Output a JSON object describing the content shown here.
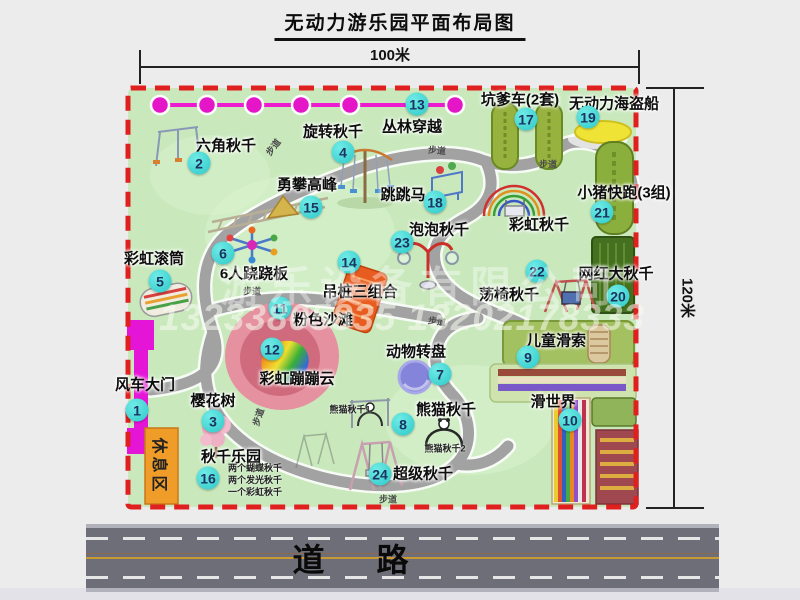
{
  "title": "无动力游乐园平面布局图",
  "dimensions": {
    "width_label": "100米",
    "height_label": "120米"
  },
  "road": {
    "label": "道路"
  },
  "watermark": {
    "company": "游乐设备有限公司",
    "phone": "13233805835 13202178333"
  },
  "rest_area": {
    "label": "休息区"
  },
  "colors": {
    "park_green": "#c9e9bd",
    "border_red": "#e01f1f",
    "badge_cyan": "#2cc9c9",
    "zipline_magenta": "#e515c8",
    "gate_magenta": "#e515d8",
    "rest_orange": "#f09c28",
    "road_gray": "#6e6e78"
  },
  "attractions": [
    {
      "num": "1",
      "name": "风车大门",
      "lx": 145,
      "ly": 384,
      "bx": 137,
      "by": 410
    },
    {
      "num": "2",
      "name": "六角秋千",
      "lx": 226,
      "ly": 145,
      "bx": 199,
      "by": 163
    },
    {
      "num": "3",
      "name": "樱花树",
      "lx": 213,
      "ly": 400,
      "bx": 213,
      "by": 421
    },
    {
      "num": "4",
      "name": "旋转秋千",
      "lx": 333,
      "ly": 131,
      "bx": 343,
      "by": 152
    },
    {
      "num": "5",
      "name": "彩虹滚筒",
      "lx": 154,
      "ly": 258,
      "bx": 160,
      "by": 281
    },
    {
      "num": "6",
      "name": "6人跷跷板",
      "lx": 254,
      "ly": 273,
      "bx": 223,
      "by": 253
    },
    {
      "num": "7",
      "name": "动物转盘",
      "lx": 416,
      "ly": 351,
      "bx": 440,
      "by": 374
    },
    {
      "num": "8",
      "name": "熊猫秋千",
      "lx": 446,
      "ly": 409,
      "bx": 403,
      "by": 424
    },
    {
      "num": "9",
      "name": "儿童滑索",
      "lx": 556,
      "ly": 340,
      "bx": 528,
      "by": 357
    },
    {
      "num": "10",
      "name": "滑世界",
      "lx": 553,
      "ly": 401,
      "bx": 570,
      "by": 420
    },
    {
      "num": "11",
      "name": "粉色沙滩",
      "lx": 323,
      "ly": 319,
      "bx": 280,
      "by": 308
    },
    {
      "num": "12",
      "name": "彩虹蹦蹦云",
      "lx": 297,
      "ly": 378,
      "bx": 272,
      "by": 349
    },
    {
      "num": "13",
      "name": "丛林穿越",
      "lx": 412,
      "ly": 126,
      "bx": 417,
      "by": 104
    },
    {
      "num": "14",
      "name": "吊桩三组合",
      "lx": 360,
      "ly": 291,
      "bx": 349,
      "by": 262
    },
    {
      "num": "15",
      "name": "勇攀高峰",
      "lx": 307,
      "ly": 184,
      "bx": 311,
      "by": 207
    },
    {
      "num": "16",
      "name": "秋千乐园",
      "lx": 231,
      "ly": 456,
      "bx": 208,
      "by": 478
    },
    {
      "num": "17",
      "name": "坑爹车(2套)",
      "lx": 520,
      "ly": 99,
      "bx": 526,
      "by": 119
    },
    {
      "num": "18",
      "name": "跳跳马",
      "lx": 403,
      "ly": 194,
      "bx": 435,
      "by": 202
    },
    {
      "num": "19",
      "name": "无动力海盗船",
      "lx": 614,
      "ly": 103,
      "bx": 588,
      "by": 117
    },
    {
      "num": "20",
      "name": "网红大秋千",
      "lx": 616,
      "ly": 273,
      "bx": 618,
      "by": 296
    },
    {
      "num": "21",
      "name": "小猪快跑(3组)",
      "lx": 624,
      "ly": 192,
      "bx": 602,
      "by": 212
    },
    {
      "num": "22",
      "name": "荡椅秋千",
      "lx": 509,
      "ly": 294,
      "bx": 537,
      "by": 271
    },
    {
      "num": "23",
      "name": "泡泡秋千",
      "lx": 439,
      "ly": 229,
      "bx": 402,
      "by": 242
    },
    {
      "num": "24",
      "name": "超级秋千",
      "lx": 423,
      "ly": 473,
      "bx": 380,
      "by": 474
    }
  ],
  "extra_labels": [
    {
      "text": "彩虹秋千",
      "x": 539,
      "y": 224
    }
  ],
  "path_labels": [
    {
      "text": "步道",
      "x": 273,
      "y": 147,
      "r": -52
    },
    {
      "text": "步道",
      "x": 437,
      "y": 150,
      "r": 5
    },
    {
      "text": "步道",
      "x": 548,
      "y": 164,
      "r": 0
    },
    {
      "text": "步道",
      "x": 252,
      "y": 291,
      "r": 0
    },
    {
      "text": "步道",
      "x": 437,
      "y": 321,
      "r": 8
    },
    {
      "text": "步道",
      "x": 258,
      "y": 417,
      "r": -72
    },
    {
      "text": "步道",
      "x": 388,
      "y": 499,
      "r": 0
    }
  ],
  "small_labels": [
    {
      "text": "熊猫秋千1",
      "x": 350,
      "y": 409
    },
    {
      "text": "熊猫秋千2",
      "x": 445,
      "y": 448
    }
  ],
  "swing_notes": {
    "x": 228,
    "y": 462,
    "lines": [
      "两个蝴蝶秋千",
      "两个发光秋千",
      "一个彩虹秋千"
    ]
  }
}
